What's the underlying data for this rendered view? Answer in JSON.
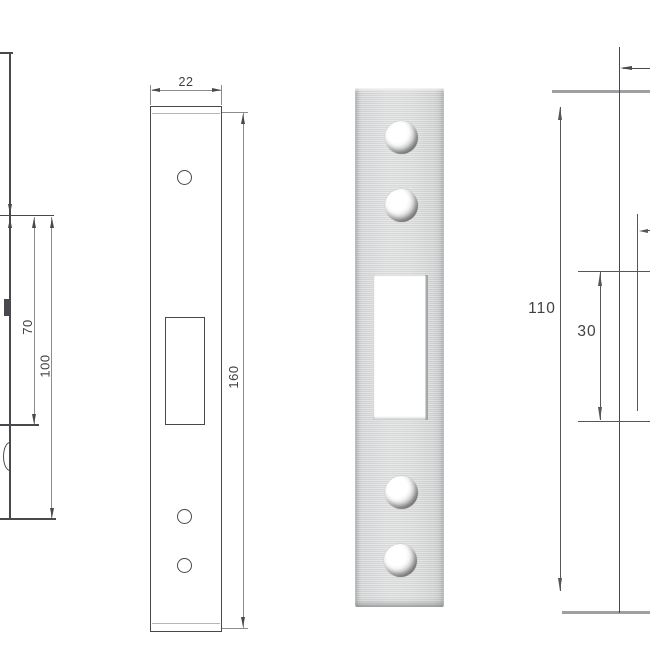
{
  "figure": {
    "side_view": {
      "dim_70": "70",
      "dim_100": "100"
    },
    "front_view": {
      "dim_width": "22",
      "dim_height": "160"
    },
    "detail_view": {
      "dim_height": "110",
      "dim_cutout": "30"
    }
  },
  "colors": {
    "background": "#ffffff",
    "line_dark": "#47494c",
    "line_mid": "#8a8c8f",
    "edge_gray": "#9da0a2",
    "steel_light": "#dfe0e1",
    "steel_dark": "#c0c1c2",
    "label_text": "#3f4144"
  }
}
